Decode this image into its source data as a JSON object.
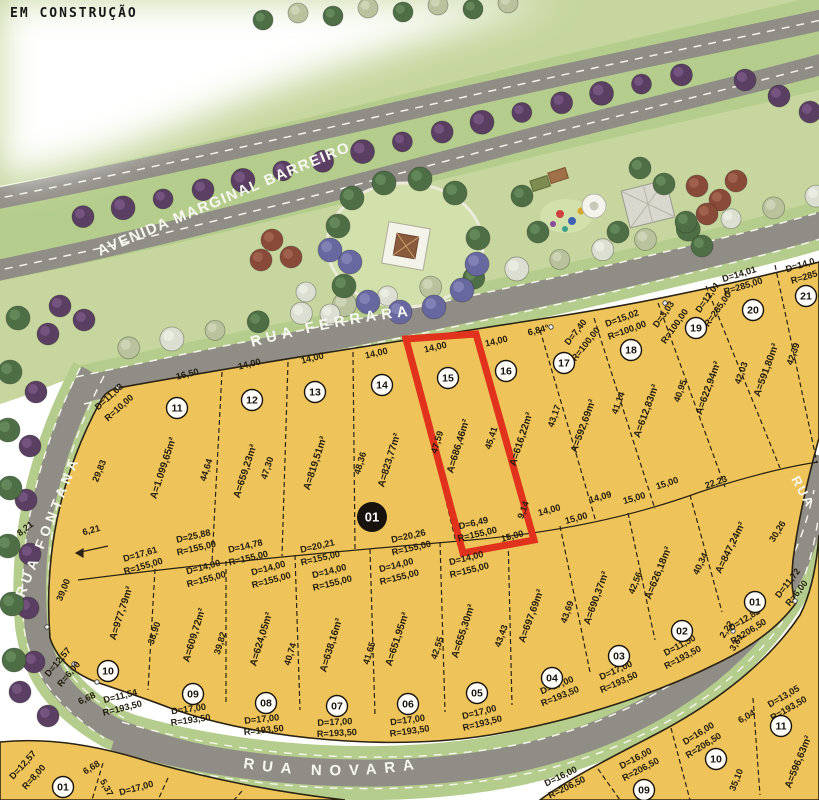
{
  "page": {
    "annotation": "EM CONSTRUÇÃO"
  },
  "streets": {
    "avenue": "AVENIDA MARGINAL BARREIRO",
    "ferrara": "RUA FERRARA",
    "fontana": "RUA FONTANA",
    "novara": "RUA NOVARA",
    "right_partial": "RUA"
  },
  "palette": {
    "lot_fill": "#eec45a",
    "road": "#908d86",
    "verge": "#b5cd8c",
    "park": "#c6d69e",
    "lawn": "#d2e0ab",
    "highlight": "#e0321c"
  },
  "quadra": {
    "number": "01"
  },
  "highlighted_lot": {
    "number": "15",
    "front": "14,00",
    "area": "A=686,46m²",
    "side": "47,59",
    "bottom": "D=6,49 R=155,00"
  },
  "badges": [
    [
      "11",
      177,
      408
    ],
    [
      "12",
      252,
      400
    ],
    [
      "13",
      315,
      392
    ],
    [
      "14",
      382,
      385
    ],
    [
      "15",
      448,
      378
    ],
    [
      "16",
      506,
      371
    ],
    [
      "17",
      564,
      363
    ],
    [
      "18",
      631,
      350
    ],
    [
      "19",
      696,
      328
    ],
    [
      "20",
      753,
      310
    ],
    [
      "21",
      806,
      296
    ],
    [
      "10",
      108,
      671
    ],
    [
      "09",
      193,
      694
    ],
    [
      "08",
      266,
      703
    ],
    [
      "07",
      337,
      706
    ],
    [
      "06",
      408,
      704
    ],
    [
      "05",
      477,
      693
    ],
    [
      "04",
      552,
      678
    ],
    [
      "03",
      619,
      656
    ],
    [
      "02",
      682,
      631
    ],
    [
      "01",
      755,
      602
    ],
    [
      "01",
      63,
      787
    ],
    [
      "09",
      644,
      790
    ],
    [
      "10",
      716,
      759
    ],
    [
      "11",
      781,
      726
    ],
    [
      "01",
      372,
      517,
      1
    ]
  ],
  "labels": [
    [
      "16,50",
      188,
      377,
      -14
    ],
    [
      "14,00",
      250,
      367,
      -14
    ],
    [
      "14,00",
      313,
      361,
      -14
    ],
    [
      "14,00",
      377,
      356,
      -13
    ],
    [
      "14,00",
      436,
      350,
      -13
    ],
    [
      "14,00",
      497,
      344,
      -13
    ],
    [
      "6,84°",
      539,
      333,
      -14
    ],
    [
      "D=11,68",
      111,
      399,
      -42
    ],
    [
      "R=10,00",
      121,
      410,
      -42
    ],
    [
      "D=7,40",
      578,
      334,
      -52
    ],
    [
      "R=100,00",
      588,
      346,
      -52
    ],
    [
      "D=15,02",
      623,
      321,
      -20
    ],
    [
      "R=100,00",
      628,
      333,
      -20
    ],
    [
      "D=3,03",
      666,
      316,
      -55
    ],
    [
      "R=100,00",
      677,
      328,
      -55
    ],
    [
      "D=12,01",
      710,
      299,
      -55
    ],
    [
      "R=285,00",
      720,
      311,
      -55
    ],
    [
      "D=14,01",
      740,
      277,
      -17
    ],
    [
      "R=285,00",
      744,
      289,
      -17
    ],
    [
      "D=14,0",
      801,
      268,
      -17
    ],
    [
      "R=285",
      805,
      280,
      -17
    ],
    [
      "A=1.099,65m²",
      166,
      469,
      -72,
      10
    ],
    [
      "A=659,23m²",
      248,
      472,
      -72,
      10
    ],
    [
      "A=819,51m²",
      318,
      464,
      -72,
      10
    ],
    [
      "A=823,77m²",
      392,
      461,
      -73,
      10
    ],
    [
      "A=686,46m²",
      461,
      447,
      -73,
      10
    ],
    [
      "A=616,22m²",
      524,
      440,
      -72,
      10
    ],
    [
      "A=592,69m²",
      586,
      427,
      -70,
      10
    ],
    [
      "A=612,83m²",
      649,
      412,
      -70,
      10
    ],
    [
      "A=622,94m²",
      711,
      389,
      -70,
      10
    ],
    [
      "A=591,80m²",
      769,
      371,
      -70,
      10
    ],
    [
      "29,83",
      102,
      472,
      -68
    ],
    [
      "44,64",
      209,
      471,
      -72
    ],
    [
      "47,30",
      270,
      469,
      -72
    ],
    [
      "48,36",
      363,
      464,
      -73
    ],
    [
      "47,59",
      440,
      443,
      -73
    ],
    [
      "45,41",
      494,
      439,
      -72
    ],
    [
      "43,17",
      557,
      417,
      -71
    ],
    [
      "41,14",
      621,
      404,
      -70
    ],
    [
      "40,95",
      683,
      392,
      -70
    ],
    [
      "42,03",
      744,
      374,
      -70
    ],
    [
      "42,39",
      796,
      355,
      -70
    ],
    [
      "D=25,88",
      194,
      539,
      -13
    ],
    [
      "R=155,00",
      197,
      551,
      -13
    ],
    [
      "D=14,78",
      246,
      549,
      -13
    ],
    [
      "R=155,00",
      249,
      561,
      -13
    ],
    [
      "D=20,21",
      318,
      549,
      -13
    ],
    [
      "R=155,00",
      321,
      561,
      -13
    ],
    [
      "D=20,26",
      409,
      539,
      -13
    ],
    [
      "R=155,00",
      412,
      551,
      -13
    ],
    [
      "D=6,49",
      474,
      526,
      -13
    ],
    [
      "R=155,00",
      478,
      537,
      -13
    ],
    [
      "9,14",
      526,
      511,
      -70
    ],
    [
      "15,00",
      513,
      539,
      -15
    ],
    [
      "14,00",
      550,
      513,
      -15
    ],
    [
      "15,00",
      577,
      521,
      -15
    ],
    [
      "14,09",
      601,
      500,
      -16
    ],
    [
      "15,00",
      635,
      501,
      -16
    ],
    [
      "15,00",
      668,
      486,
      -18
    ],
    [
      "22,23",
      717,
      485,
      -20
    ],
    [
      "6,21",
      92,
      533,
      -15
    ],
    [
      "8,21",
      27,
      531,
      -38
    ],
    [
      "D=17,61",
      141,
      557,
      -16
    ],
    [
      "R=155,00",
      144,
      569,
      -16
    ],
    [
      "D=14,00",
      204,
      570,
      -15
    ],
    [
      "R=155,00",
      207,
      582,
      -15
    ],
    [
      "D=14,00",
      269,
      571,
      -15
    ],
    [
      "R=155,00",
      272,
      583,
      -15
    ],
    [
      "D=14,00",
      330,
      574,
      -14
    ],
    [
      "R=155,00",
      333,
      586,
      -14
    ],
    [
      "D=14,00",
      397,
      568,
      -14
    ],
    [
      "R=155,00",
      400,
      580,
      -14
    ],
    [
      "D=14,00",
      467,
      561,
      -14
    ],
    [
      "R=155,00",
      470,
      573,
      -14
    ],
    [
      "39,00",
      66,
      591,
      -68
    ],
    [
      "A=977,79m²",
      124,
      614,
      -72,
      10
    ],
    [
      "38,90",
      157,
      634,
      -72
    ],
    [
      "A=609,72m²",
      197,
      636,
      -73,
      10
    ],
    [
      "39,82",
      223,
      644,
      -73
    ],
    [
      "A=624,05m²",
      264,
      640,
      -73,
      10
    ],
    [
      "40,74",
      293,
      655,
      -73
    ],
    [
      "A=638,16m²",
      334,
      646,
      -73,
      10
    ],
    [
      "41,65",
      372,
      654,
      -73
    ],
    [
      "A=651,95m²",
      400,
      640,
      -72,
      10
    ],
    [
      "42,55",
      440,
      649,
      -72
    ],
    [
      "A=655,30m²",
      466,
      632,
      -72,
      10
    ],
    [
      "43,43",
      504,
      637,
      -70
    ],
    [
      "A=697,69m²",
      534,
      617,
      -70,
      10
    ],
    [
      "43,69",
      570,
      613,
      -70
    ],
    [
      "A=690,37m²",
      599,
      599,
      -70,
      10
    ],
    [
      "42,56",
      638,
      584,
      -68
    ],
    [
      "A=626,18m²",
      661,
      574,
      -68,
      10
    ],
    [
      "40,34",
      703,
      565,
      -64
    ],
    [
      "A=847,24m²",
      733,
      549,
      -64,
      10
    ],
    [
      "30,26",
      780,
      533,
      -58
    ],
    [
      "D=12,57",
      60,
      664,
      -50
    ],
    [
      "R=6,00",
      71,
      676,
      -50
    ],
    [
      "6,68",
      88,
      701,
      -25
    ],
    [
      "D=11,54",
      121,
      699,
      -14
    ],
    [
      "R=193,50",
      123,
      711,
      -14
    ],
    [
      "D=17,00",
      189,
      712,
      -8
    ],
    [
      "R=193,50",
      191,
      723,
      -8
    ],
    [
      "D=17,00",
      262,
      722,
      -6
    ],
    [
      "R=193,50",
      264,
      733,
      -6
    ],
    [
      "D=17,00",
      335,
      725,
      -3
    ],
    [
      "R=193,50",
      337,
      736,
      -3
    ],
    [
      "D=17,00",
      408,
      723,
      -8
    ],
    [
      "R=193,50",
      410,
      734,
      -8
    ],
    [
      "D=17,00",
      480,
      715,
      -14
    ],
    [
      "R=193,50",
      483,
      726,
      -14
    ],
    [
      "D=17,00",
      558,
      688,
      -22
    ],
    [
      "R=193,50",
      561,
      699,
      -22
    ],
    [
      "D=17,00",
      617,
      673,
      -24
    ],
    [
      "R=193,50",
      620,
      685,
      -24
    ],
    [
      "D=11,50",
      681,
      648,
      -28
    ],
    [
      "R=193,50",
      684,
      660,
      -28
    ],
    [
      "2,22",
      729,
      631,
      -58
    ],
    [
      "3,61",
      739,
      644,
      -58
    ],
    [
      "D=12,82",
      746,
      622,
      -32
    ],
    [
      "R=206,50",
      750,
      634,
      -32
    ],
    [
      "D=11,72",
      790,
      585,
      -52
    ],
    [
      "R=6,00",
      799,
      595,
      -52
    ],
    [
      "D=12,57",
      25,
      767,
      -48
    ],
    [
      "R=8,00",
      36,
      779,
      -48
    ],
    [
      "6,68",
      93,
      770,
      -32
    ],
    [
      "5,37",
      104,
      789,
      62
    ],
    [
      "D=17,00",
      137,
      791,
      -15
    ],
    [
      "D=16,00",
      562,
      779,
      -26
    ],
    [
      "R=206,50",
      568,
      790,
      -26
    ],
    [
      "D=16,00",
      637,
      761,
      -28
    ],
    [
      "R=206,50",
      642,
      772,
      -28
    ],
    [
      "D=16,00",
      700,
      736,
      -32
    ],
    [
      "R=206,50",
      705,
      748,
      -32
    ],
    [
      "6,04",
      748,
      719,
      -30
    ],
    [
      "D=13,05",
      785,
      699,
      -30
    ],
    [
      "R=193,50",
      790,
      711,
      -30
    ],
    [
      "A=596,63m²",
      801,
      763,
      -68,
      10
    ],
    [
      "35,10",
      739,
      781,
      -68
    ]
  ]
}
